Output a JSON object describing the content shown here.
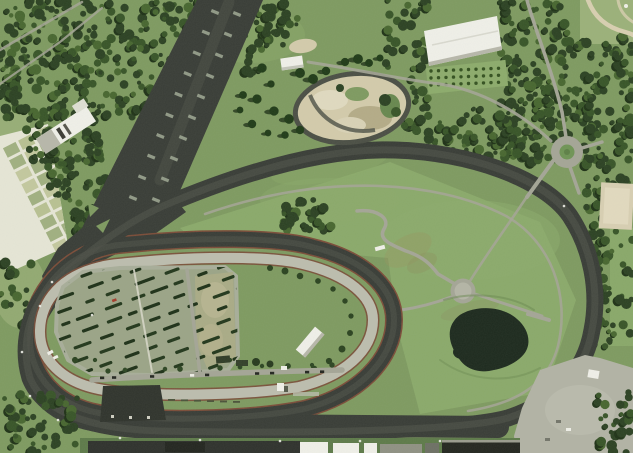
{
  "meta": {
    "description": "Aerial satellite photograph of a racetrack complex: a dark asphalt road course and wide start chute surrounding a tan horse-track oval, infield parking lot with diagonal tree rows, infield pond, roundabout, gravel loop, white buildings, garden plots and dense woodland",
    "width": 633,
    "height": 453
  },
  "palette": {
    "asphalt": "#383c36",
    "asphalt_worn": "#4b4f46",
    "tan_track": "#bcbdae",
    "road": "#a4a596",
    "path_light": "#d6d6c7",
    "red_edge": "#7b4c38",
    "grass": "#7e9a60",
    "grass_light": "#8cab6b",
    "grass_pale": "#a3b780",
    "grass_dark": "#67874e",
    "forest": "#2b4122",
    "forest_mid": "#375427",
    "forest_light": "#47662f",
    "forest_shadow": "#1e3116",
    "conifer": "#1f3a17",
    "pond": "#1c291d",
    "dirt": "#d3cbab",
    "dirt_dark": "#b4ab87",
    "dirt_pale": "#e0dac0",
    "white": "#f0f0e9",
    "roof_shadow": "#b7b7aa",
    "dark_bldg": "#2f332c",
    "plot_a": "#b8c192",
    "plot_b": "#a0b080",
    "plot_c": "#c3c89e",
    "plot_line": "#e6e6d6",
    "apron": "#b2b3a5",
    "tree_row": "#22371b",
    "car_red": "#a33b2a",
    "sand_path": "#d8cfb0"
  },
  "scene": {
    "landmarks": [
      "north-west-forest",
      "drag-strip-chute",
      "outer-road-course",
      "inner-asphalt-oval",
      "tan-horse-track",
      "infield-parking-lot",
      "parking-tree-rows",
      "infield-pond",
      "roundabout",
      "gravel-moto-loop",
      "white-hall-building",
      "garden-plots",
      "infield-squiggle-path",
      "circular-pad",
      "service-road",
      "paved-apron",
      "grandstand-roofs",
      "orchard-rows",
      "park-corner-path"
    ]
  }
}
